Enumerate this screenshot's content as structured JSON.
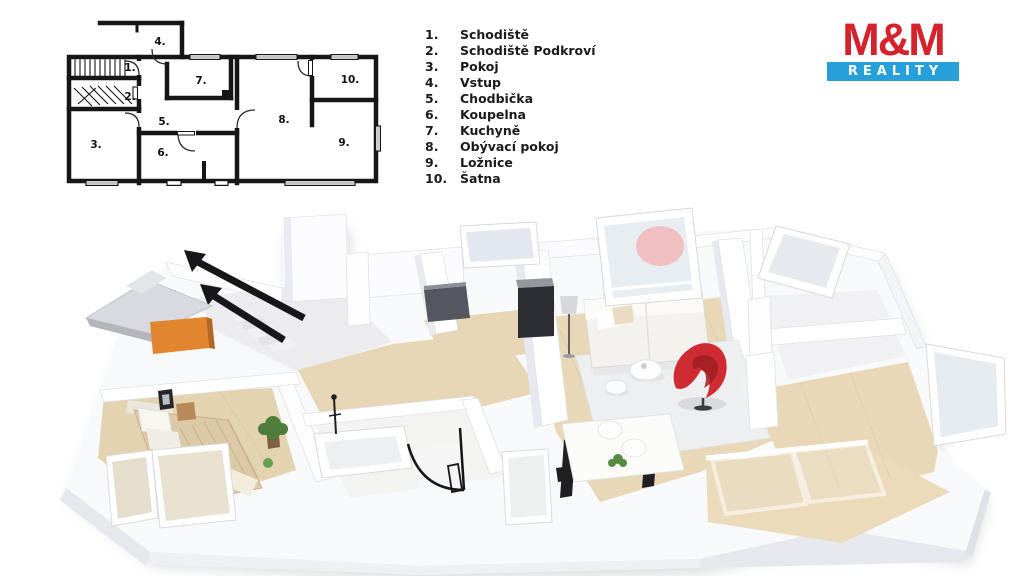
{
  "legend": {
    "items": [
      {
        "num": "1.",
        "label": "Schodiště"
      },
      {
        "num": "2.",
        "label": "Schodiště Podkroví"
      },
      {
        "num": "3.",
        "label": "Pokoj"
      },
      {
        "num": "4.",
        "label": "Vstup"
      },
      {
        "num": "5.",
        "label": "Chodbička"
      },
      {
        "num": "6.",
        "label": "Koupelna"
      },
      {
        "num": "7.",
        "label": "Kuchyně"
      },
      {
        "num": "8.",
        "label": "Obývací pokoj"
      },
      {
        "num": "9.",
        "label": "Ložnice"
      },
      {
        "num": "10.",
        "label": "Šatna"
      }
    ]
  },
  "logo": {
    "line1": "M&M",
    "line2": "REALITY",
    "red": "#d5232e",
    "blue": "#279fd9"
  },
  "plan2d": {
    "labels": [
      {
        "text": "1."
      },
      {
        "text": "2."
      },
      {
        "text": "3."
      },
      {
        "text": "4."
      },
      {
        "text": "5."
      },
      {
        "text": "6."
      },
      {
        "text": "7."
      },
      {
        "text": "8."
      },
      {
        "text": "9."
      },
      {
        "text": "10."
      }
    ]
  },
  "colors": {
    "wall_black": "#161616",
    "wood_floor": "#e7d6b6",
    "accent_chair_red": "#ce2b33",
    "cabinet_orange": "#e2852f",
    "logo_red": "#d5232e",
    "logo_blue": "#279fd9"
  }
}
